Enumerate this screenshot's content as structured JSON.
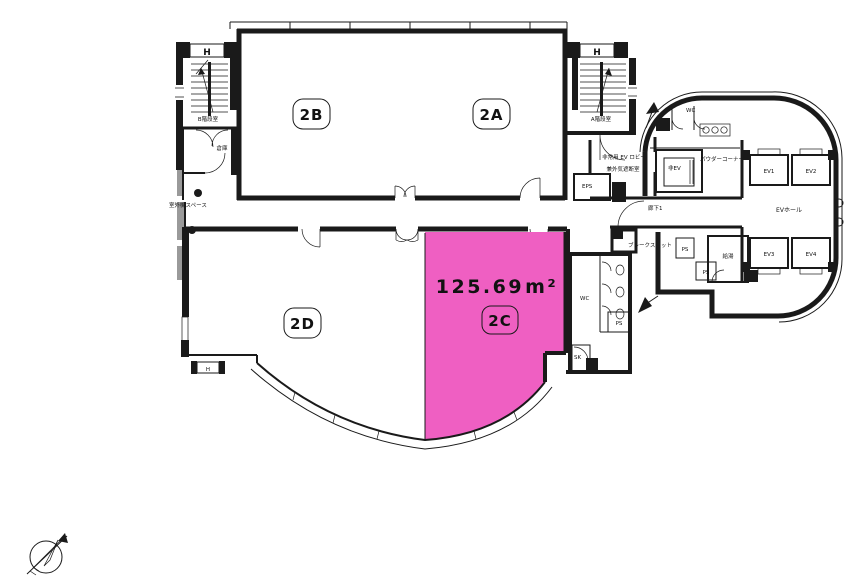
{
  "colors": {
    "highlight": "#EF5FC2",
    "line": "#1a1a1a"
  },
  "rooms": {
    "a": "2A",
    "b": "2B",
    "c": "2C",
    "d": "2D"
  },
  "area": {
    "value": "125.69",
    "unit": "m²"
  },
  "labels": {
    "h": "H",
    "stair_b": "B階段室",
    "stair_a": "A階段室",
    "storage": "倉庫",
    "outdoor_units": "室外機スペース",
    "ev_lobby_line1": "非常用 EV ロビー",
    "ev_lobby_line2": "兼外気遮断室",
    "eps": "EPS",
    "corridor1": "廊下1",
    "break_spot": "ブレークスポット",
    "wc": "WC",
    "emergency_ev": "非EV",
    "powder_corner": "パウダーコーナー",
    "ev_hall": "EVホール",
    "ev1": "EV1",
    "ev2": "EV2",
    "ev3": "EV3",
    "ev4": "EV4",
    "kitchenette": "給湯",
    "ps": "PS",
    "sk": "SK"
  }
}
